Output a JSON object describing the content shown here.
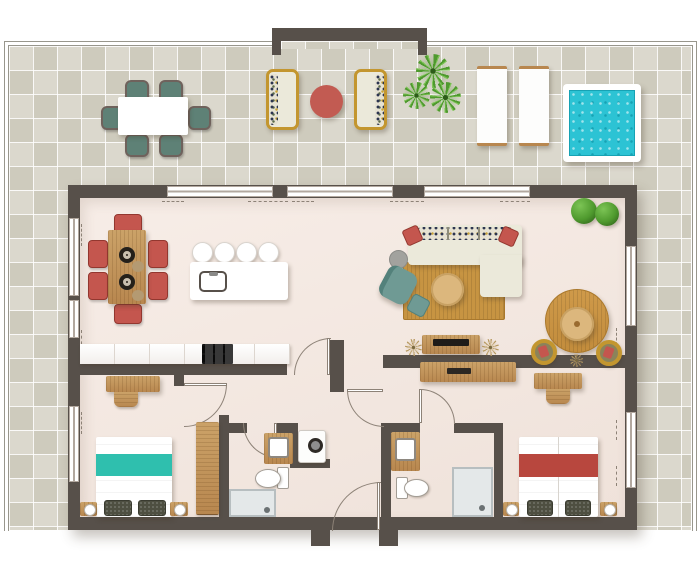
{
  "plan_type": "apartment-floor-plan-top-view",
  "colors": {
    "wall": "#57504a",
    "line": "#8d8277",
    "frame": "#b2a89f",
    "rail": "#98968c",
    "floor1": "#f7ede7",
    "floor2": "#efe2da",
    "tile": "#dbd8cd",
    "tileAlt": "rgba(176,172,152,0.30)",
    "grid": "rgba(255,255,255,0.85)",
    "wood1": "#cba268",
    "wood2": "#b8874f",
    "grain": "rgba(96,60,20,0.18)",
    "cream": "#ebe9da",
    "sofaBack": "#ded9c4",
    "red": "#c4564e",
    "redDark": "#93372f",
    "redSpread": "#b8473e",
    "redTable": "#c25b52",
    "tealSpread": "#2fbfae",
    "tealChair": "#6f9a94",
    "tealDeep": "#53817b",
    "terraceChair": "#5e8176",
    "terraceChairEdge": "#6f625c",
    "pool": "#2cc3d4",
    "poolDeep": "#17a2b4",
    "rug": "#c79442",
    "rugEdge": "#a9782c",
    "green": "#4f9a2e",
    "greenLight": "#7cc455",
    "greenDeep": "#2c5c18",
    "tan": "#b89b63",
    "gold": "#c3962f",
    "grayTable": "#a2a29e",
    "bath": "#e4e8e9",
    "bathEdge": "#b7bec0",
    "applianceDark": "#141414",
    "shadow": "rgba(70,55,40,0.30)"
  },
  "rooms": [
    {
      "name": "terrace",
      "items": [
        "outdoor-dining-table",
        "outdoor-chair x6",
        "garden-loveseat x2",
        "round-red-side-table",
        "palm-plant x3",
        "sun-lounger x2",
        "plunge-pool"
      ]
    },
    {
      "name": "kitchen-dining",
      "items": [
        "dining-table",
        "dining-chair x6",
        "plate x2",
        "kitchen-island",
        "sink",
        "bar-stool x4",
        "counter",
        "cooktop"
      ]
    },
    {
      "name": "living-room",
      "items": [
        "corner-sofa",
        "red-pillow x2",
        "area-rug",
        "round-coffee-table",
        "armchair",
        "ottoman",
        "side-table",
        "tv-console",
        "tv",
        "dried-plant x3",
        "round-rug",
        "bistro-table",
        "tub-chair x2",
        "hedge-bush x2"
      ]
    },
    {
      "name": "hallway",
      "items": [
        "sideboard"
      ]
    },
    {
      "name": "bedroom-1",
      "items": [
        "desk",
        "desk-chair",
        "wardrobe",
        "double-bed-teal",
        "nightstand x2",
        "lamp x2"
      ]
    },
    {
      "name": "bathroom-1",
      "items": [
        "vanity-sink",
        "toilet",
        "shower",
        "washing-machine"
      ]
    },
    {
      "name": "bathroom-2",
      "items": [
        "vanity-sink",
        "toilet",
        "shower"
      ]
    },
    {
      "name": "bedroom-2",
      "items": [
        "desk",
        "desk-chair",
        "twin-bed-red",
        "nightstand x2",
        "lamp x2"
      ]
    },
    {
      "name": "entry",
      "items": [
        "front-door"
      ]
    }
  ],
  "doors": [
    "kitchen-door",
    "hall-living-door",
    "bathroom-1-door",
    "bathroom-2-door",
    "bedroom-1-door",
    "front-door"
  ],
  "windows": [
    "top-slider x3",
    "left-window x3",
    "right-window x2"
  ]
}
